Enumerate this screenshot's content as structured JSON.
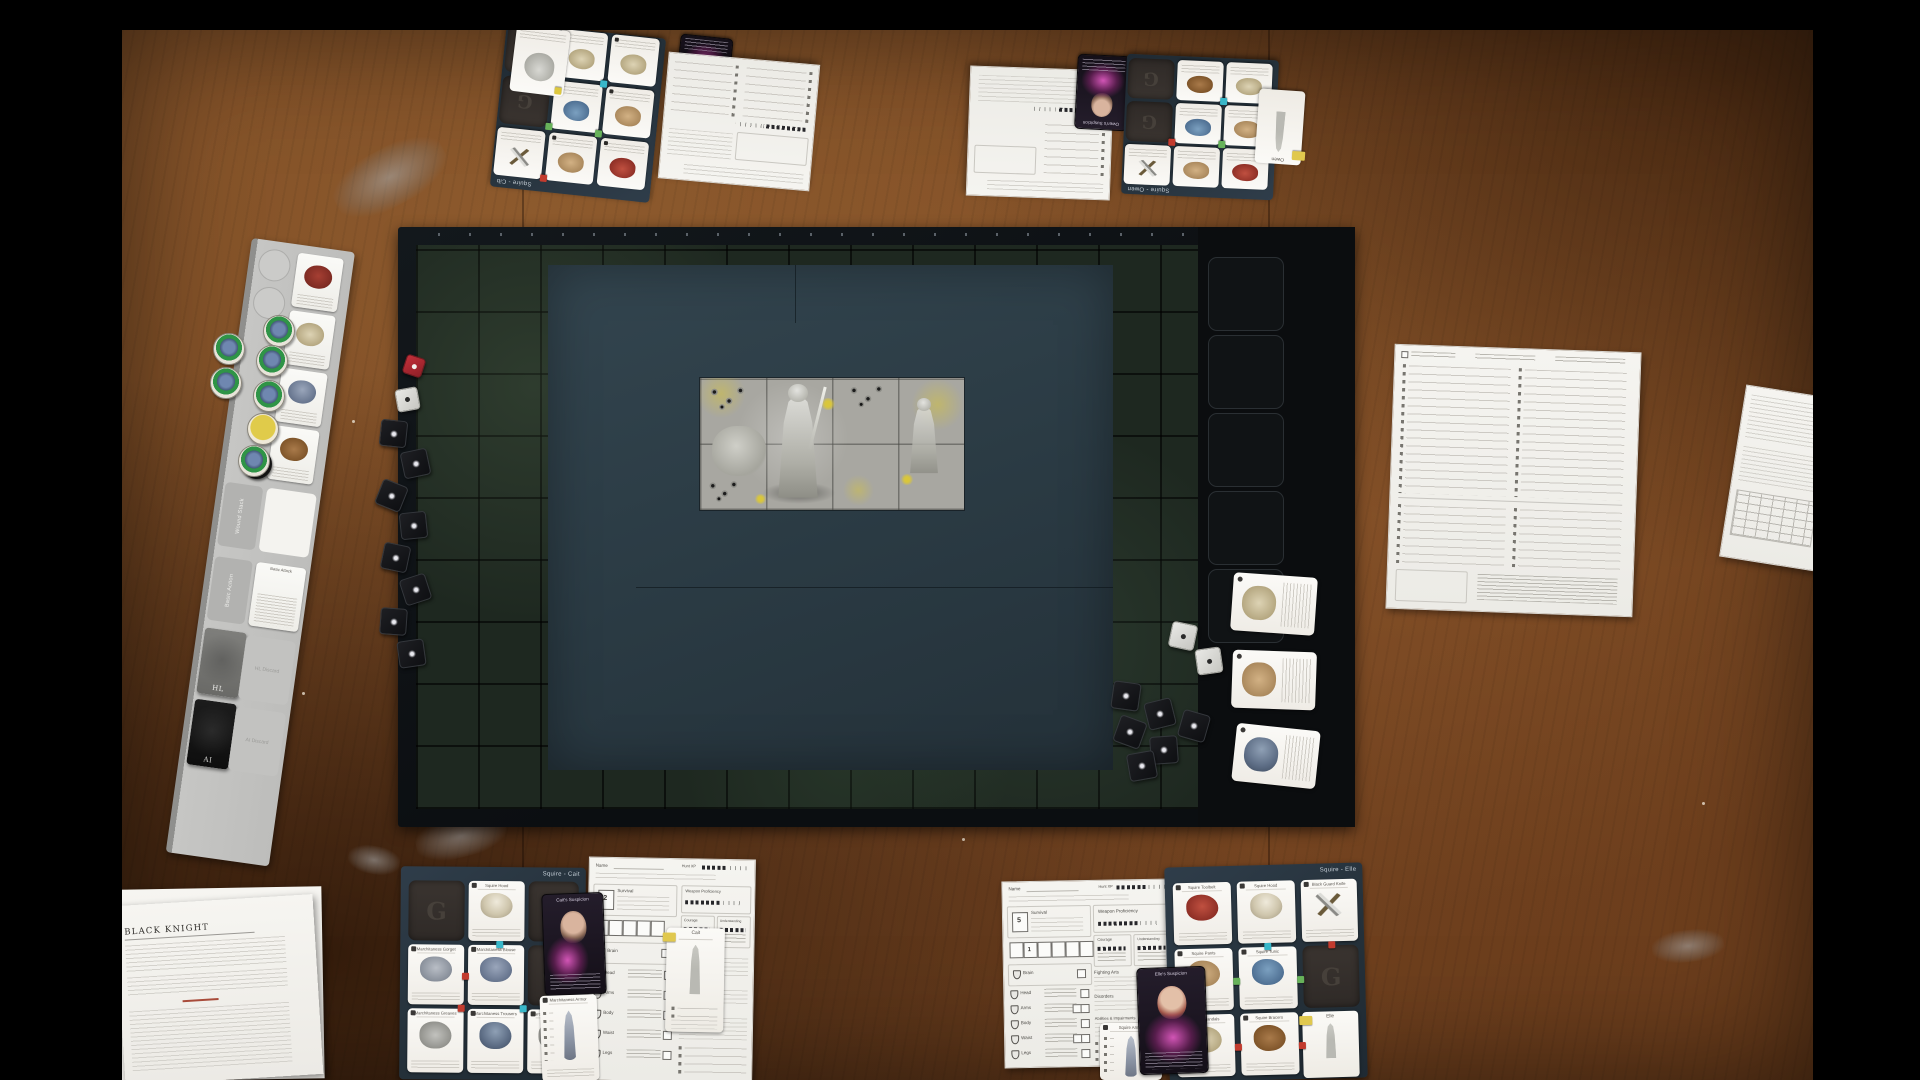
{
  "game": {
    "gear_slot_letter": "G",
    "rulebook_title": "BLACK KNIGHT"
  },
  "palette": {
    "table_wood": "#7b4a24",
    "showdown_board": "#10151a",
    "board_tiles": "#1e2820",
    "hidden_area": "#2d3c45",
    "stone_tiles": "#a8a7a1",
    "player_board": "#2b3844",
    "suspicion_glow": "#d44fb4",
    "marker_red": "#c23b2e",
    "marker_green": "#67b25a",
    "marker_cyan": "#38b7c9",
    "marker_yellow": "#ddc83f",
    "token_ring_green": "#2f9447",
    "die_black": "#141517",
    "die_red": "#b5262b"
  },
  "sidebar": {
    "wound_stack": "Wound Stack",
    "basic_action": "Basic Action",
    "basic_attack": "Basic Attack",
    "hl_deck": "HL",
    "hl_discard": "HL Discard",
    "ai_deck": "AI",
    "ai_discard": "AI Discard"
  },
  "sheet_labels": {
    "name": "Name",
    "survival": "Survival",
    "brain": "Brain",
    "weapon_proficiency": "Weapon Proficiency",
    "courage": "Courage",
    "understanding": "Understanding",
    "fighting_arts": "Fighting Arts",
    "disorders": "Disorders",
    "abilities": "Abilities & Impairments",
    "hunt_xp": "Hunt XP",
    "armor_rows": [
      "Head",
      "Arms",
      "Body",
      "Waist",
      "Legs"
    ]
  },
  "players": {
    "top_left": {
      "board_label": "Squire - Cib",
      "suspicion_card": "Cib's Suspicion"
    },
    "top_right": {
      "board_label": "Squire - Owen",
      "suspicion_card": "Owen's Suspicion",
      "mini_card": "Owen"
    },
    "cait": {
      "board_label": "Squire - Cait",
      "suspicion_card": "Cait's Suspicion",
      "mini_card": "Cait",
      "survival_value": "2",
      "cards": {
        "hood": "Squire Hood",
        "gorget": "Marchitaness Gorget",
        "blouse": "Marchitaness Blouse",
        "greaves": "Marchitaness Greaves",
        "trousers": "Marchitaness Trousers",
        "sollerets": "Marchitaness Sollerets",
        "armor": "Marchitaness Armor"
      }
    },
    "elle": {
      "board_label": "Squire - Elle",
      "suspicion_card": "Elle's Suspicion",
      "mini_card": "Elle",
      "survival_value": "5",
      "secondary_value": "1",
      "cards": {
        "toolbelt": "Squire Toolbelt",
        "hood": "Squire Hood",
        "knife": "Black Guard Knife",
        "pants": "Squire Pants",
        "tunic": "Squire Tunic",
        "sandals": "Squire Sandals",
        "bracers": "Squire Bracers",
        "armor": "Squire Armor"
      }
    }
  }
}
